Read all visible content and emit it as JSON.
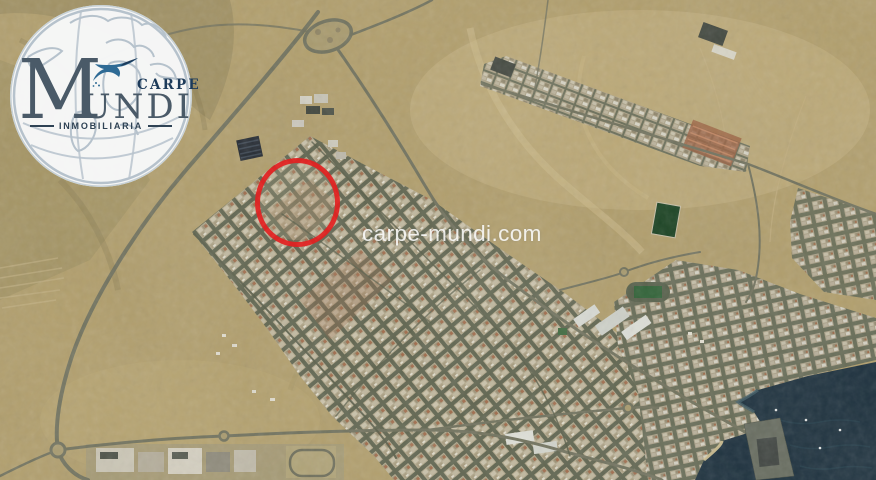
{
  "logo": {
    "carpe": "CARPE",
    "mundi_initial": "M",
    "mundi_rest": "UNDI",
    "tagline": "INMOBILIARIA",
    "colors": {
      "brand": "#4a5a68",
      "carpe_navy": "#1d3b5a",
      "bird_blue": "#2f6b95",
      "globe_line": "#b6c2cc",
      "disc": "#f8f9fa",
      "tagline_color": "#2e4254"
    }
  },
  "map": {
    "kind": "satellite aerial photo of coastal desert town",
    "watermark": "carpe-mundi.com",
    "watermark_color": "rgba(255,255,255,0.85)",
    "marker": {
      "shape": "circle",
      "color": "#e32121",
      "cx": 297,
      "cy": 202,
      "rx": 40,
      "ry": 42,
      "stroke": 5
    },
    "terrain_colors": {
      "desert": "#b19e6b",
      "desert_light": "#c8b485",
      "urban_street": "#5f644e",
      "urban_block": "#b3a98c",
      "water": "#1b2f3c",
      "road": "#70715c",
      "field_green": "#17401f"
    }
  }
}
